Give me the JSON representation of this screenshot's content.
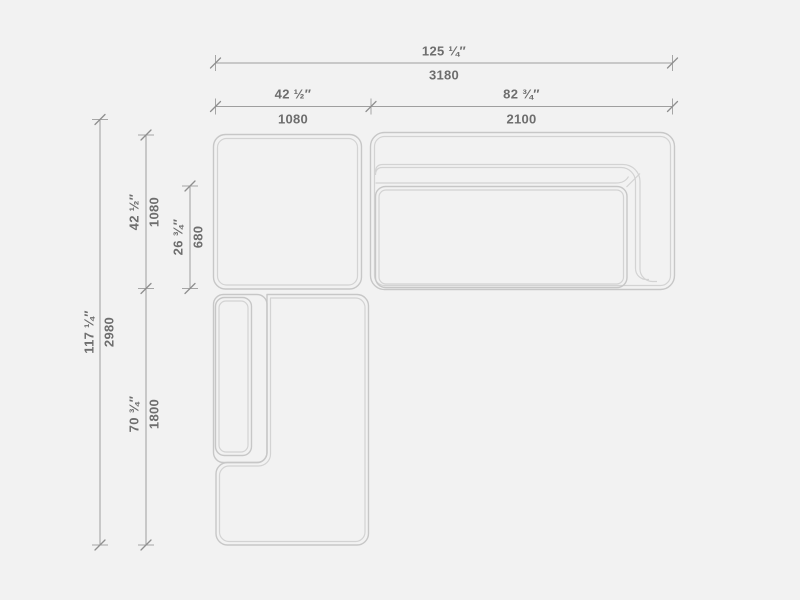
{
  "dimensions": {
    "overall_width": {
      "imperial": "125 ¼″",
      "metric": "3180"
    },
    "left_module_width": {
      "imperial": "42 ½″",
      "metric": "1080"
    },
    "right_module_width": {
      "imperial": "82 ¾″",
      "metric": "2100"
    },
    "overall_depth": {
      "imperial": "117 ¼″",
      "metric": "2980"
    },
    "upper_module_depth": {
      "imperial": "42 ½″",
      "metric": "1080"
    },
    "seat_depth": {
      "imperial": "26 ¾″",
      "metric": "680"
    },
    "chaise_length": {
      "imperial": "70 ¾″",
      "metric": "1800"
    }
  },
  "colors": {
    "background": "#f2f2f2",
    "furniture_line": "#c7c7c7",
    "furniture_inner_line": "#d3d3d3",
    "dimension_line": "#9f9f9f",
    "label_text": "#6e6e6e"
  }
}
